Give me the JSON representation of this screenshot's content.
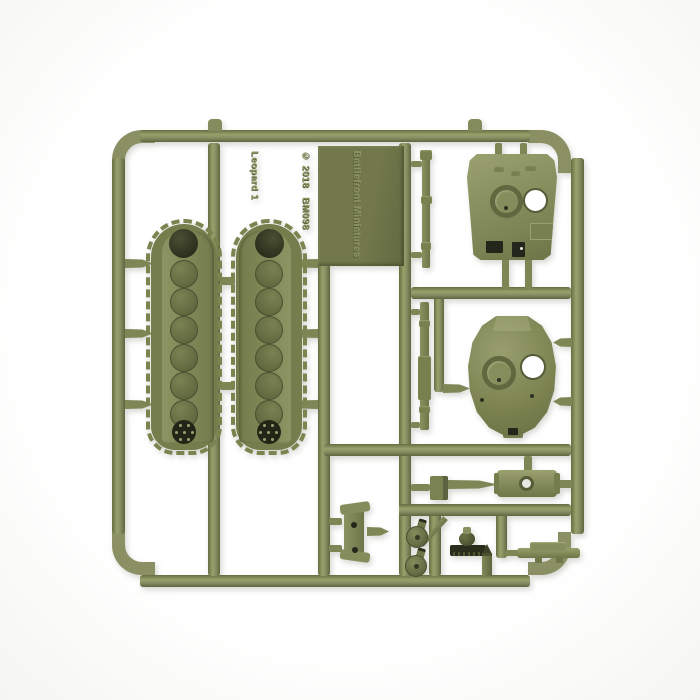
{
  "scene": {
    "type": "product-photo",
    "subject": "Olive green injection-molded plastic model sprue with Leopard 1 tank parts on white background",
    "background_color": "#ffffff"
  },
  "plate_text": {
    "line1": "Battlefront Miniatures",
    "line2": "© 2018   BM098",
    "line3": "Leopard 1"
  },
  "colors": {
    "plastic": "#8a9064",
    "plastic_light": "#9aa06f",
    "plastic_dark": "#666d41",
    "label_plate": "#6e744a",
    "dark_detail": "#232617",
    "background": "#ffffff"
  },
  "parts": [
    "hull-top-panel",
    "turret-top",
    "track-run-left",
    "track-run-right",
    "gun-barrel-upper",
    "gun-barrel-lower",
    "storage-bin",
    "crew-hatch-upper",
    "crew-hatch-lower",
    "gun-mantlet",
    "muzzle-brake-assembly",
    "travel-lock",
    "shell-tip-part",
    "small-block-part"
  ]
}
